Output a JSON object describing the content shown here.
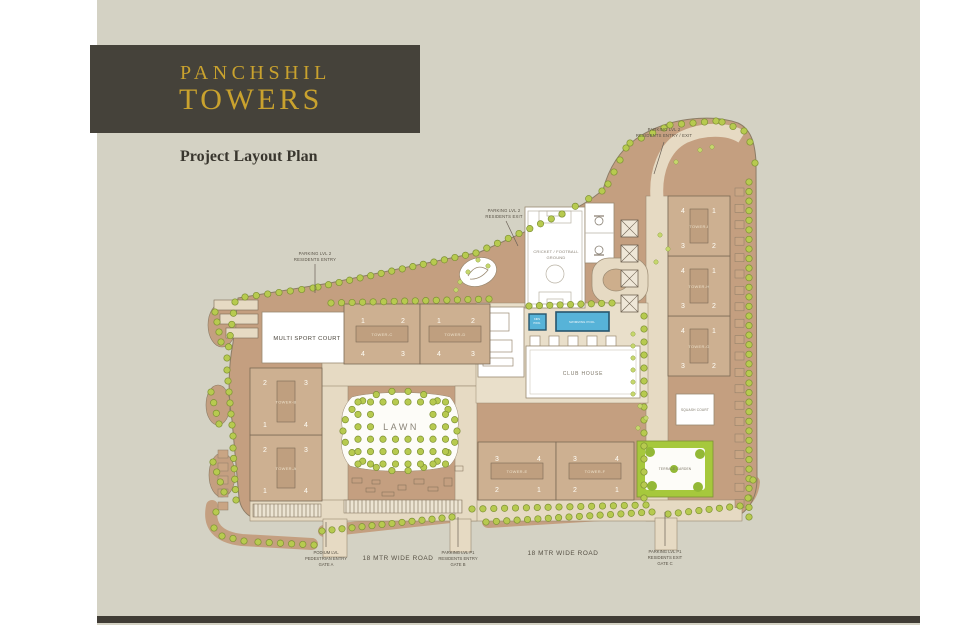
{
  "brand": {
    "name_line1": "PANCHSHIL",
    "name_line2": "TOWERS"
  },
  "page": {
    "title": "Project Layout Plan"
  },
  "towers": [
    {
      "id": "A",
      "label": "TOWER-A",
      "units": [
        "2",
        "3",
        "1",
        "4"
      ]
    },
    {
      "id": "B",
      "label": "TOWER-B",
      "units": [
        "2",
        "3",
        "1",
        "4"
      ]
    },
    {
      "id": "C",
      "label": "TOWER-C",
      "units": [
        "1",
        "2",
        "4",
        "3"
      ]
    },
    {
      "id": "D",
      "label": "TOWER-D",
      "units": [
        "1",
        "2",
        "4",
        "3"
      ]
    },
    {
      "id": "E",
      "label": "TOWER-E",
      "units": [
        "3",
        "4",
        "2",
        "1"
      ]
    },
    {
      "id": "F",
      "label": "TOWER-F",
      "units": [
        "3",
        "4",
        "2",
        "1"
      ]
    },
    {
      "id": "G",
      "label": "TOWER-G",
      "units": [
        "4",
        "1",
        "3",
        "2"
      ]
    },
    {
      "id": "H",
      "label": "TOWER-H",
      "units": [
        "4",
        "1",
        "3",
        "2"
      ]
    },
    {
      "id": "I",
      "label": "TOWER-I",
      "units": [
        "4",
        "1",
        "3",
        "2"
      ]
    }
  ],
  "amenities": {
    "multi_sport_court": "MULTI SPORT COURT",
    "cricket_ground": [
      "CRICKET / FOOTBALL",
      "GROUND"
    ],
    "club_house": "CLUB HOUSE",
    "swimming_pool": "SWIMMING POOL",
    "kids_pool": [
      "KIDS",
      "POOL"
    ],
    "lawn": "LAWN",
    "squash_court": "SQUASH COURT",
    "terrace_garden": "TERRACE GARDEN"
  },
  "callouts": {
    "parking_entry_left": [
      "PARKING LVL 2",
      "RESIDENTS ENTRY"
    ],
    "parking_exit_top": [
      "PARKING LVL 2",
      "RESIDENTS EXIT"
    ],
    "parking_entry_exit_right": [
      "PARKING LVL 2",
      "RESIDENTS ENTRY / EXIT"
    ]
  },
  "roads": {
    "road_label_left": "18 MTR WIDE ROAD",
    "road_label_right": "18 MTR WIDE ROAD",
    "gate_a": [
      "PODIUM LVL",
      "PEDESTRIAN ENTRY",
      "GATE A"
    ],
    "gate_b": [
      "PARKING LVL P1",
      "RESIDENTS ENTRY",
      "GATE B"
    ],
    "gate_c": [
      "PARKING LVL P1",
      "RESIDENTS EXIT",
      "GATE C"
    ]
  },
  "colors": {
    "logo_bg": "#45423a",
    "gold": "#c9a22e",
    "panel": "#d4d2c4",
    "site_tan": "#c49f80",
    "building": "#cdb091",
    "tree_green": "#b7ca4f",
    "pool_blue": "#57b3d8",
    "footer_dark": "#403c35"
  }
}
